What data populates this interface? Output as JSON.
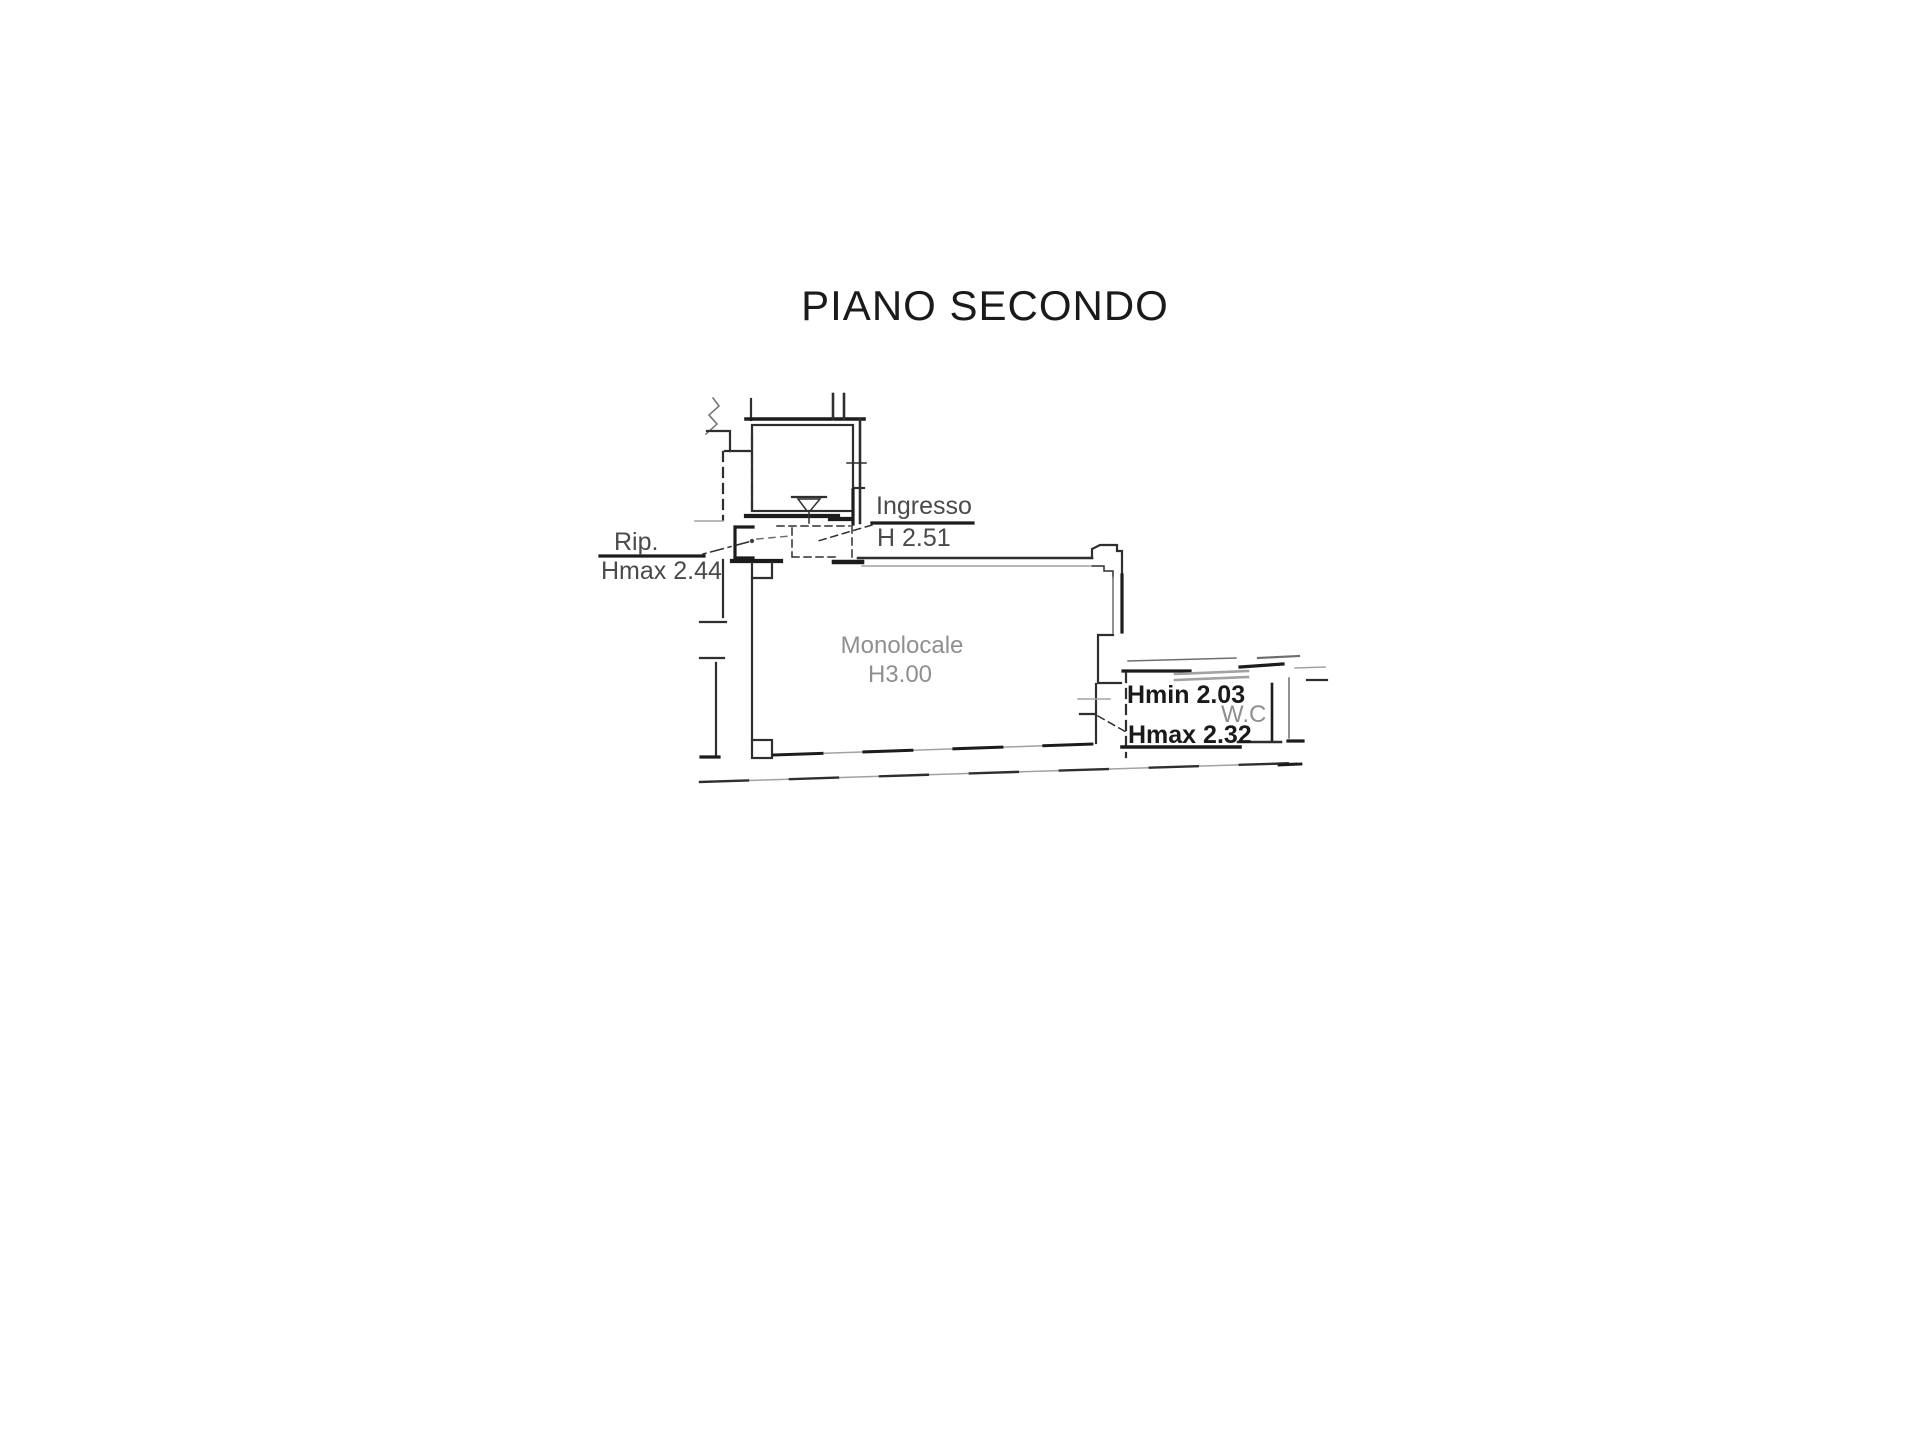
{
  "title": "PIANO SECONDO",
  "plan": {
    "entry": {
      "label": "Ingresso",
      "height": "H 2.51"
    },
    "storage": {
      "label": "Rip.",
      "height": "Hmax 2.44"
    },
    "main_room": {
      "label": "Monolocale",
      "height": "H3.00"
    },
    "bathroom": {
      "label": "W.C",
      "height_min": "Hmin 2.03",
      "height_max": "Hmax 2.32"
    }
  },
  "colors": {
    "line": "#2f2f2f",
    "line_dark": "#1c1c1c",
    "line_light": "#a2a2a2",
    "text_dark": "#1a1a1a",
    "text_gray": "#8f8f8f"
  }
}
